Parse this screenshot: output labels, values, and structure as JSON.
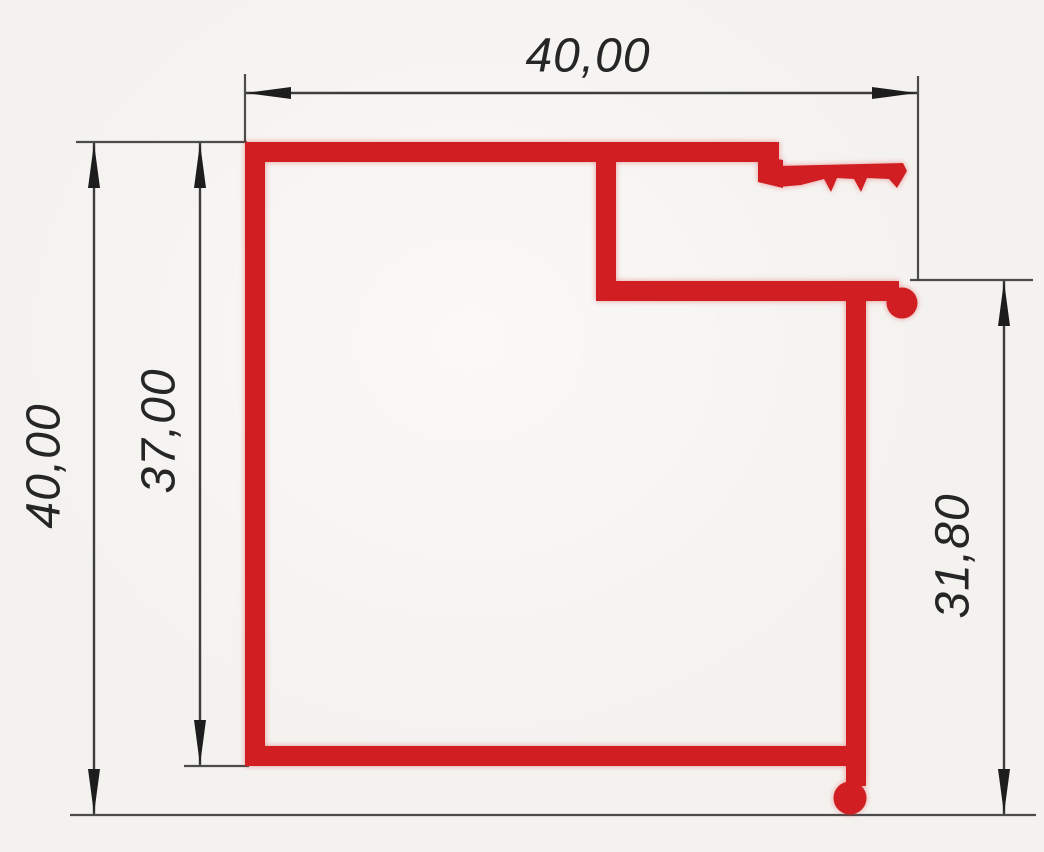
{
  "drawing": {
    "type": "technical-dimension-drawing",
    "subject": "extruded-profile-cross-section",
    "colors": {
      "profile": "#d11e22",
      "dimension_lines": "#3d3d3d",
      "text": "#262626",
      "background": "#f4f2ef"
    },
    "dimensions": [
      {
        "id": "top-width",
        "label": "40,00",
        "orientation": "horizontal",
        "side": "top"
      },
      {
        "id": "overall-height",
        "label": "40,00",
        "orientation": "vertical",
        "side": "left-outer"
      },
      {
        "id": "body-height",
        "label": "37,00",
        "orientation": "vertical",
        "side": "left-inner"
      },
      {
        "id": "right-flange-height",
        "label": "31,80",
        "orientation": "vertical",
        "side": "right"
      }
    ]
  }
}
